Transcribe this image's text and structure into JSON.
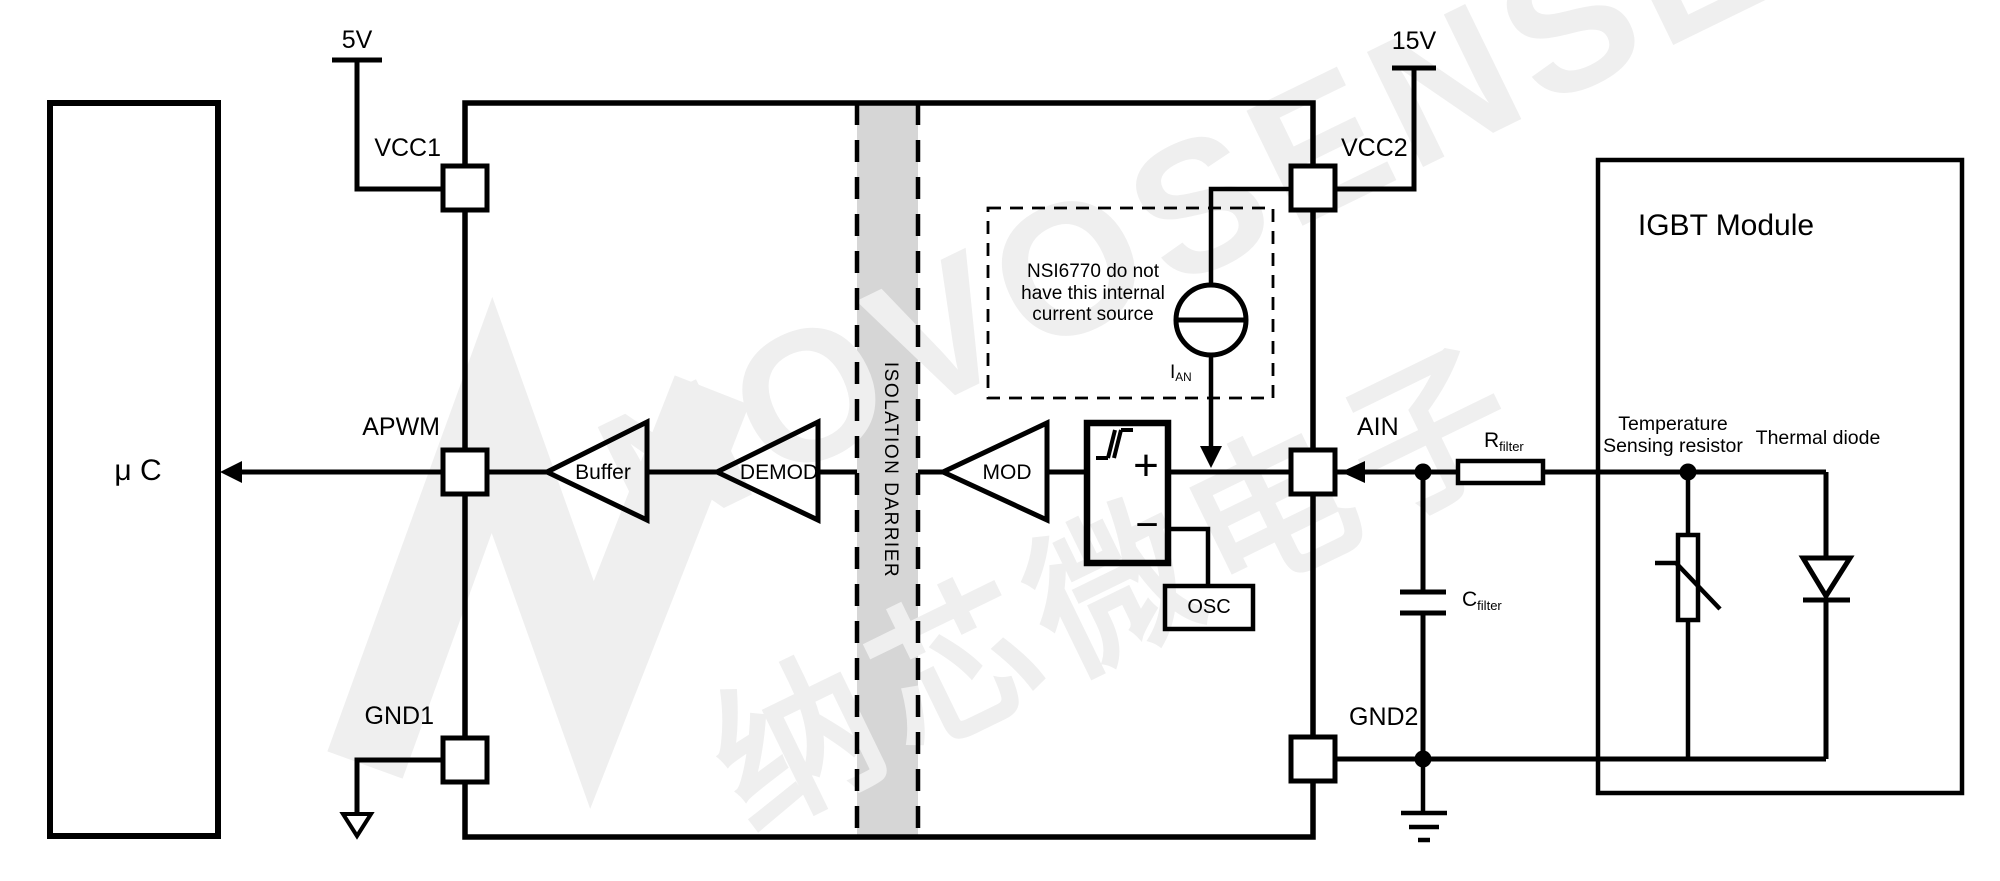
{
  "supply": {
    "v1": "5V",
    "v2": "15V"
  },
  "mcu": {
    "label": "μ C"
  },
  "pins": {
    "vcc1": "VCC1",
    "apwm": "APWM",
    "gnd1": "GND1",
    "vcc2": "VCC2",
    "ain": "AIN",
    "gnd2": "GND2"
  },
  "blocks": {
    "buffer": "Buffer",
    "demod": "DEMOD",
    "mod": "MOD",
    "osc": "OSC",
    "plus": "+",
    "minus": "−"
  },
  "isolation": {
    "label": "ISOLATION DARRIER"
  },
  "note": {
    "line1": "NSI6770 do not",
    "line2": "have this internal",
    "line3": "current source"
  },
  "ian": {
    "main": "I",
    "sub": "AN"
  },
  "rfilter": {
    "main": "R",
    "sub": "filter"
  },
  "cfilter": {
    "main": "C",
    "sub": "filter"
  },
  "igbt": {
    "title": "IGBT Module",
    "temp1": "Temperature",
    "temp2": "Sensing resistor",
    "diode": "Thermal diode"
  },
  "watermark": {
    "brand": "NOVOSENSE",
    "cn": "纳芯微电子"
  },
  "colors": {
    "line": "#000000",
    "band": "#d6d6d6",
    "watermark": "#efefef",
    "background": "#ffffff"
  }
}
